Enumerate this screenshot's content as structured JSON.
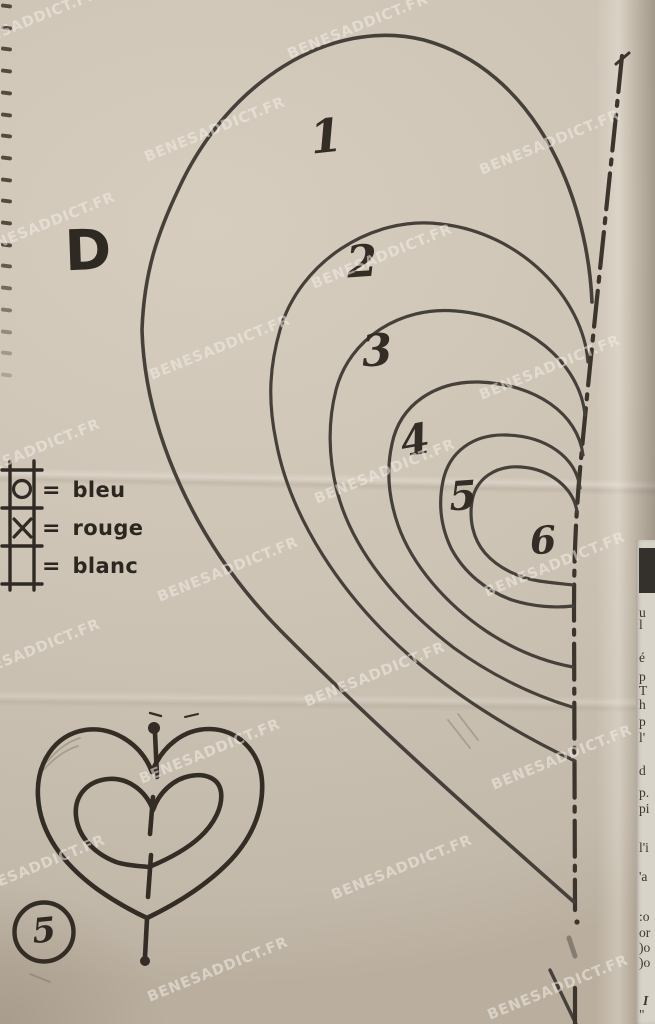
{
  "watermark": {
    "text": "BENESADDICT.FR",
    "positions": [
      [
        28,
        22
      ],
      [
        358,
        27
      ],
      [
        215,
        130
      ],
      [
        550,
        143
      ],
      [
        45,
        225
      ],
      [
        382,
        257
      ],
      [
        220,
        348
      ],
      [
        550,
        368
      ],
      [
        30,
        452
      ],
      [
        385,
        472
      ],
      [
        228,
        570
      ],
      [
        555,
        565
      ],
      [
        30,
        652
      ],
      [
        375,
        675
      ],
      [
        210,
        752
      ],
      [
        562,
        758
      ],
      [
        35,
        868
      ],
      [
        402,
        868
      ],
      [
        218,
        970
      ],
      [
        558,
        988
      ]
    ]
  },
  "pattern": {
    "piece_label": "D",
    "curve_labels": [
      {
        "n": "1",
        "x": 326,
        "y": 136,
        "size": 46,
        "rot": -6
      },
      {
        "n": "2",
        "x": 362,
        "y": 262,
        "size": 44,
        "rot": -4
      },
      {
        "n": "3",
        "x": 377,
        "y": 351,
        "size": 44,
        "rot": -4
      },
      {
        "n": "4",
        "x": 415,
        "y": 440,
        "size": 42,
        "rot": -10
      },
      {
        "n": "5",
        "x": 463,
        "y": 496,
        "size": 40,
        "rot": -4
      },
      {
        "n": "6",
        "x": 543,
        "y": 540,
        "size": 38,
        "rot": -4
      }
    ],
    "legend": {
      "eq": "=",
      "items": [
        {
          "symbol": "square-circle",
          "label": "bleu"
        },
        {
          "symbol": "square-cross",
          "label": "rouge"
        },
        {
          "symbol": "square-empty",
          "label": "blanc"
        }
      ]
    },
    "figure_number": "5"
  },
  "side_column": {
    "fragments": [
      {
        "t": "u",
        "y": 612
      },
      {
        "t": "l",
        "y": 624
      },
      {
        "t": "é",
        "y": 657
      },
      {
        "t": "p",
        "y": 676
      },
      {
        "t": "T",
        "y": 690
      },
      {
        "t": "h",
        "y": 704
      },
      {
        "t": "p",
        "y": 721
      },
      {
        "t": "l'",
        "y": 737
      },
      {
        "t": "d",
        "y": 770
      },
      {
        "t": "p.",
        "y": 792
      },
      {
        "t": "pi",
        "y": 808
      },
      {
        "t": "l'i",
        "y": 847
      },
      {
        "t": "'a",
        "y": 876
      },
      {
        "t": ":o",
        "y": 916
      },
      {
        "t": "or",
        "y": 932
      },
      {
        "t": ")o",
        "y": 947
      },
      {
        "t": ")o",
        "y": 962
      },
      {
        "t": "I",
        "y": 1000,
        "italic": true
      },
      {
        "t": "\"",
        "y": 1014
      }
    ]
  },
  "perforations": {
    "count": 18,
    "y_start": 4,
    "y_step": 21.7
  },
  "colors": {
    "paper": "#cdc3b5",
    "paper_light": "#d6cdbf",
    "paper_dark": "#baaf9f",
    "ink": "#46403a",
    "ink_dark": "#2e2922",
    "strip_paper": "#d8d3c8",
    "photo_block": "#34312c",
    "watermark_text": "rgba(243,237,227,0.55)"
  }
}
